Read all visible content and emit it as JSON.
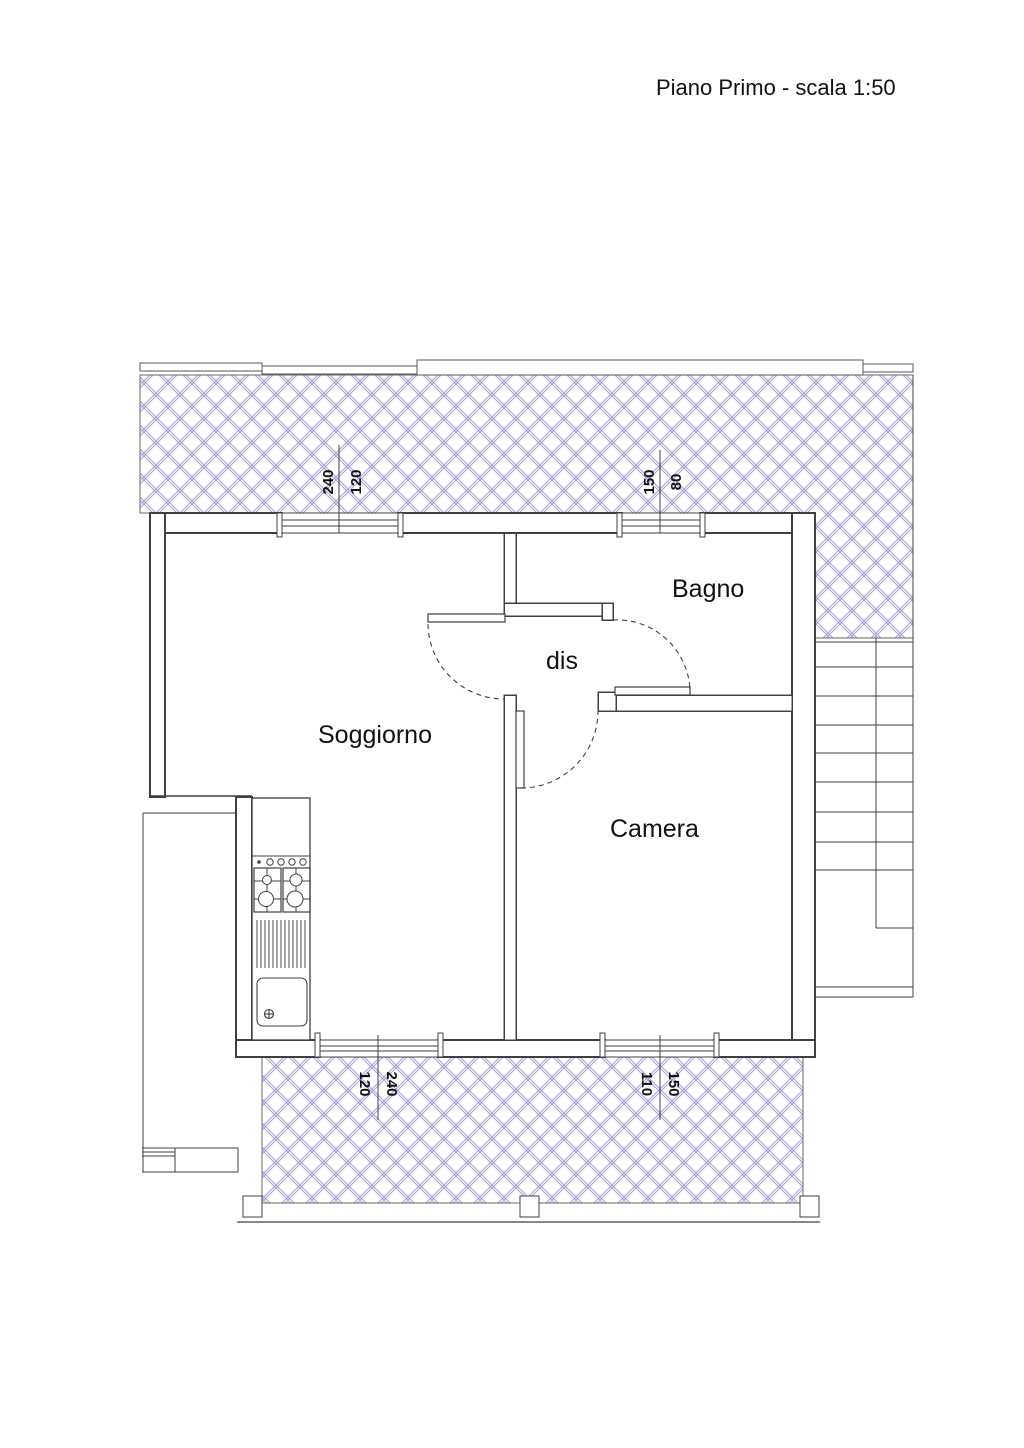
{
  "title": "Piano Primo - scala 1:50",
  "rooms": {
    "soggiorno": "Soggiorno",
    "bagno": "Bagno",
    "dis": "dis",
    "camera": "Camera"
  },
  "dimensions": {
    "top_left": {
      "first": "240",
      "second": "120"
    },
    "top_right": {
      "first": "150",
      "second": "80"
    },
    "bottom_left": {
      "first": "120",
      "second": "240"
    },
    "bottom_right": {
      "first": "110",
      "second": "150"
    }
  },
  "colors": {
    "hatch": "#a79fd3",
    "line": "#404040",
    "text": "#111111",
    "background": "#ffffff"
  }
}
